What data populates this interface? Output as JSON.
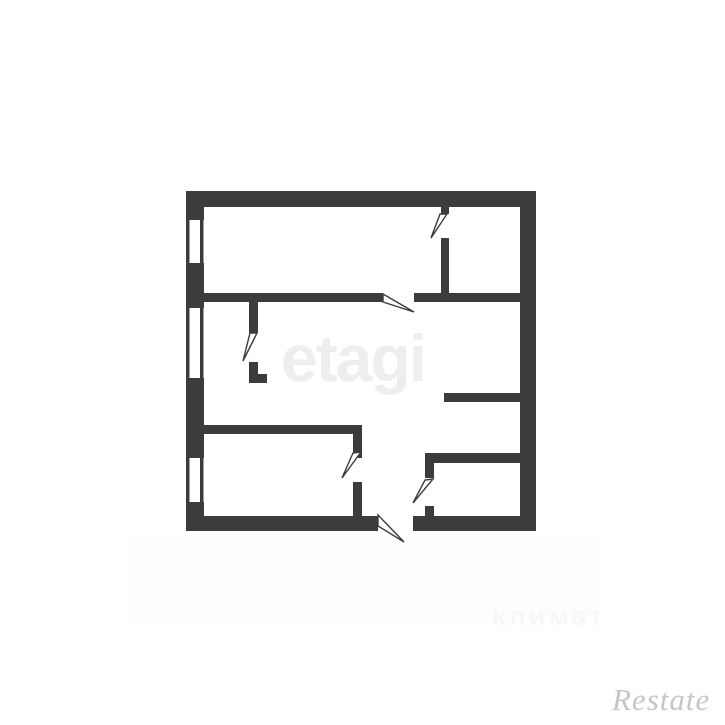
{
  "image": {
    "background_color": "#ffffff"
  },
  "floorplan": {
    "wall_color": "#3c3c3c",
    "door_fill": "#ffffff",
    "elements": {
      "windows_count": 3,
      "interior_doors_count": 5,
      "entrance_doors_count": 1
    }
  },
  "watermarks": {
    "center": {
      "text": "etagi",
      "color": "#eeeeee"
    },
    "bottom": {
      "text": "климат",
      "color": "#f8f7f8"
    },
    "corner": {
      "text": "Restate",
      "color": "#c6c6c6"
    }
  }
}
